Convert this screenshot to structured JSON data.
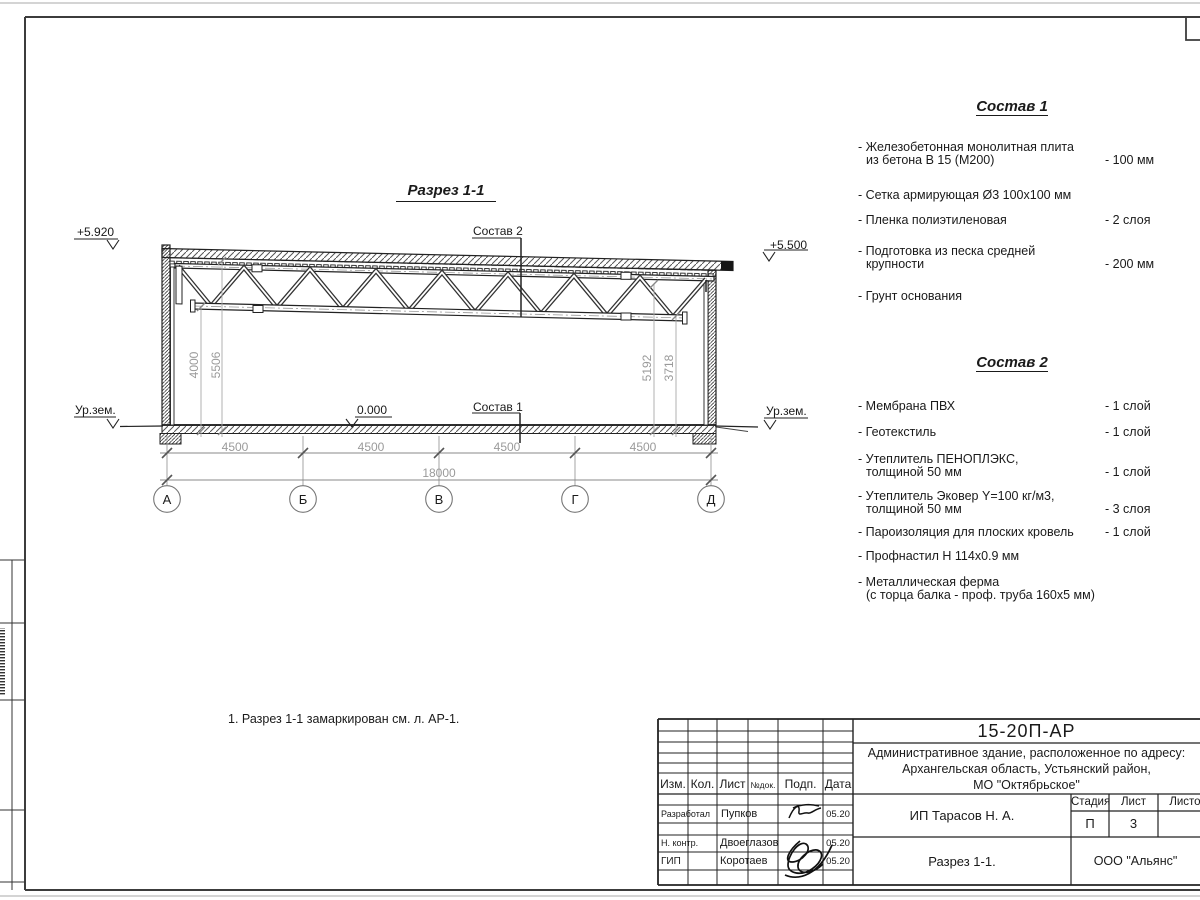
{
  "drawing": {
    "title": "Разрез 1-1",
    "note": "1. Разрез 1-1 замаркирован см. л. АР-1.",
    "elevations": {
      "roof_left": "+5.920",
      "roof_right": "+5.500",
      "floor": "0.000",
      "ground_left": "Ур.зем.",
      "ground_right": "Ур.зем."
    },
    "section_labels": {
      "sostav1": "Состав 1",
      "sostav2": "Состав 2"
    },
    "axes": [
      "А",
      "Б",
      "В",
      "Г",
      "Д"
    ],
    "dims_horizontal": [
      "4500",
      "4500",
      "4500",
      "4500"
    ],
    "dim_total": "18000",
    "dims_vertical": {
      "left_inner": "4000",
      "left_outer": "5506",
      "right_inner": "5192",
      "right_outer": "3718"
    }
  },
  "sostav1": {
    "title": "Состав 1",
    "items": [
      {
        "line1": "- Железобетонная  монолитная плита",
        "line2": "из бетона В 15 (М200)",
        "value": "- 100 мм"
      },
      {
        "line1": "- Сетка армирующая Ø3 100х100 мм"
      },
      {
        "line1": "- Пленка полиэтиленовая",
        "value": "-  2 слоя"
      },
      {
        "line1": "- Подготовка из песка средней",
        "line2": "крупности",
        "value": "- 200 мм"
      },
      {
        "line1": "- Грунт основания"
      }
    ]
  },
  "sostav2": {
    "title": "Состав 2",
    "items": [
      {
        "line1": "- Мембрана ПВХ",
        "value": "- 1 слой"
      },
      {
        "line1": "- Геотекстиль",
        "value": "- 1 слой"
      },
      {
        "line1": "- Утеплитель ПЕНОПЛЭКС,",
        "line2": "толщиной 50 мм",
        "value": "- 1 слой"
      },
      {
        "line1": "- Утеплитель Эковер Y=100 кг/м3,",
        "line2": "толщиной 50 мм",
        "value": "- 3 слоя"
      },
      {
        "line1": "- Пароизоляция для плоских кровель",
        "value": "- 1 слой"
      },
      {
        "line1": "- Профнастил Н 114х0.9 мм"
      },
      {
        "line1": "- Металлическая ферма",
        "line2": "(с торца балка - проф. труба 160х5 мм)"
      }
    ]
  },
  "titleblock": {
    "doc_code": "15-20П-АР",
    "address_line1": "Административное здание, расположенное по адресу:",
    "address_line2": "Архангельская область, Устьянский район,",
    "address_line3": "МО \"Октябрьское\"",
    "cols": {
      "izm": "Изм.",
      "kol": "Кол.",
      "list": "Лист",
      "ndoc": "№док.",
      "podp": "Подп.",
      "data": "Дата"
    },
    "rows": [
      {
        "role": "Разработал",
        "name": "Пупков",
        "date": "05.20"
      },
      {
        "role": "Н. контр.",
        "name": "Двоеглазов",
        "date": "05.20"
      },
      {
        "role": "ГИП",
        "name": "Коротаев",
        "date": "05.20"
      }
    ],
    "client": "ИП Тарасов Н. А.",
    "sheet_name": "Разрез 1-1.",
    "company": "ООО \"Альянс\"",
    "stage": {
      "label": "Стадия",
      "value": "П"
    },
    "sheet": {
      "label": "Лист",
      "value": "3"
    },
    "sheets": {
      "label": "Листов",
      "value": ""
    }
  }
}
